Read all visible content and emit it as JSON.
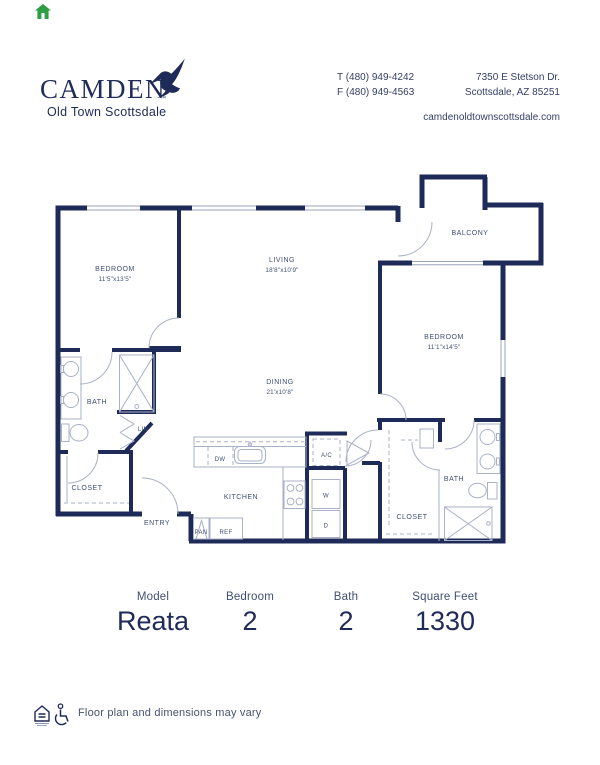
{
  "page": {
    "home_icon": "green-house"
  },
  "header": {
    "logo_text": "CAMDEN",
    "logo_tm": "™",
    "logo_subtitle": "Old Town Scottsdale",
    "phone_t": "T (480) 949-4242",
    "phone_f": "F (480) 949-4563",
    "address_line1": "7350 E Stetson Dr.",
    "address_line2": "Scottsdale, AZ 85251",
    "website": "camdenoldtownscottsdale.com"
  },
  "floorplan": {
    "bedroom1": {
      "name": "BEDROOM",
      "dims": "11'5\"x13'5\""
    },
    "living": {
      "name": "LIVING",
      "dims": "18'8\"x10'9\""
    },
    "balcony": {
      "name": "BALCONY"
    },
    "bedroom2": {
      "name": "BEDROOM",
      "dims": "11'1\"x14'5\""
    },
    "dining": {
      "name": "DINING",
      "dims": "21'x10'8\""
    },
    "kitchen": {
      "name": "KITCHEN"
    },
    "bath1": {
      "name": "BATH"
    },
    "bath2": {
      "name": "BATH"
    },
    "closet1": {
      "name": "CLOSET"
    },
    "closet2": {
      "name": "CLOSET"
    },
    "entry": {
      "name": "ENTRY"
    },
    "lin": {
      "name": "LIN"
    },
    "pan": {
      "name": "PAN"
    },
    "ref": {
      "name": "REF"
    },
    "dw": {
      "name": "DW"
    },
    "ac": {
      "name": "A/C"
    },
    "washer": {
      "name": "W"
    },
    "dryer": {
      "name": "D"
    }
  },
  "summary": {
    "columns": [
      {
        "label": "Model",
        "value": "Reata"
      },
      {
        "label": "Bedroom",
        "value": "2"
      },
      {
        "label": "Bath",
        "value": "2"
      },
      {
        "label": "Square Feet",
        "value": "1330"
      }
    ]
  },
  "footer": {
    "disclaimer": "Floor plan and dimensions may vary"
  },
  "colors": {
    "wall_navy": "#1e2a57",
    "thin_line": "#9aa3ba",
    "fixture_line": "#a9b1c6",
    "label_gray_navy": "#3f4f73",
    "house_icon_green": "#2e9e44"
  }
}
